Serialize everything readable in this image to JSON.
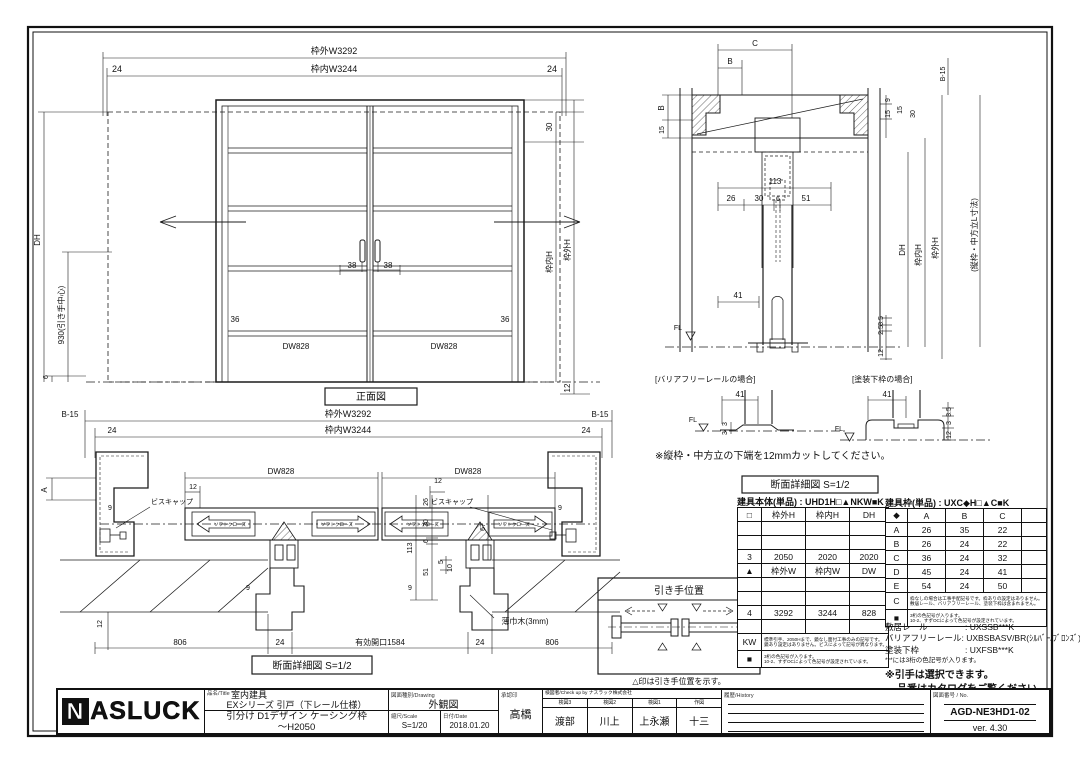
{
  "front": {
    "caption": "正面図",
    "w_out": "枠外W3292",
    "w_in": "枠内W3244",
    "m24l": "24",
    "m24r": "24",
    "h30": "30",
    "h_in": "枠内H",
    "h_out": "枠外H",
    "d12": "12",
    "dh": "DH",
    "center": "930(引き手中心)",
    "d6": "6",
    "d38l": "38",
    "d38r": "38",
    "d36l": "36",
    "d36r": "36",
    "dwl": "DW828",
    "dwr": "DW828"
  },
  "vsec": {
    "c": "C",
    "b_top": "B",
    "b_left": "B",
    "d15l": "15",
    "d9": "9",
    "d15a": "15",
    "d15b": "15",
    "d30": "30",
    "d113": "113",
    "d26": "26",
    "d30b": "30",
    "d6": "6",
    "d51": "51",
    "d41": "41",
    "d35": "3.5",
    "d25": "2.5",
    "d12": "12",
    "dh": "DH",
    "h_in": "枠内H",
    "h_out": "枠外H",
    "lnote": "(縦枠・中方立L寸法)",
    "b15": "B-15",
    "fl": "FL"
  },
  "details": {
    "left_title": "[バリアフリーレールの場合]",
    "right_title": "[塗装下枠の場合]",
    "l41": "41",
    "l3a": "3",
    "l3b": "3",
    "lfl": "FL",
    "r41": "41",
    "r35": "3.5",
    "r3": "3",
    "r12": "12",
    "rfl": "FL",
    "note": "※縦枠・中方立の下端を12mmカットしてください。",
    "caption": "断面詳細図 S=1/2"
  },
  "plan": {
    "b15l": "B-15",
    "b15r": "B-15",
    "w_out": "枠外W3292",
    "w_in": "枠内W3244",
    "m24l": "24",
    "m24r": "24",
    "dwl": "DW828",
    "dwr": "DW828",
    "d12l": "12",
    "d12r": "12",
    "d26": "26",
    "d30": "30",
    "d113": "113",
    "d6": "6",
    "d51": "51",
    "a": "A",
    "d67": "67",
    "d9a": "9",
    "d9b": "9",
    "d9c": "9",
    "d9d": "9",
    "d5": "5",
    "d10": "10",
    "d12b": "12",
    "biscap_l": "ビスキャップ",
    "biscap_r": "ビスキャップ",
    "soft1": "ソフトクローズ",
    "soft2": "ソフトクローズ",
    "soft3": "ソフトクローズ",
    "soft4": "ソフトクローズ",
    "skirting": "薄巾木(3mm)",
    "d806l": "806",
    "d24l": "24",
    "opening": "有効開口1584",
    "d24r": "24",
    "d806r": "806",
    "caption": "断面詳細図 S=1/2"
  },
  "handle": {
    "title": "引き手位置",
    "caption": "△印は引き手位置を示す。"
  },
  "table1": {
    "title": "建具本体(単品) : UHD1H□▲NKW■K",
    "h": [
      "□",
      "枠外H",
      "枠内H",
      "DH"
    ],
    "r3": [
      "3",
      "2050",
      "2020",
      "2020"
    ],
    "h2": [
      "▲",
      "枠外W",
      "枠内W",
      "DW"
    ],
    "r4": [
      "4",
      "3292",
      "3244",
      "828"
    ],
    "kw": "KW",
    "kw_note1": "標準引手、2050Hまで、鏡なし面付工事のみの記号です。",
    "kw_note2": "鏡あり設定はありません。ビスによって記号が異なります。",
    "sq": "■",
    "sq_note1": "3桁の色記号が入ります。",
    "sq_note2": "10-2、すずOCによって色記号が設定されています。"
  },
  "table2": {
    "title": "建具枠(単品) : UXC◆H□▲C■K",
    "h": [
      "◆",
      "A",
      "B",
      "C",
      ""
    ],
    "rows": [
      [
        "A",
        "26",
        "35",
        "22"
      ],
      [
        "B",
        "26",
        "24",
        "22"
      ],
      [
        "C",
        "36",
        "24",
        "32"
      ],
      [
        "D",
        "45",
        "24",
        "41"
      ],
      [
        "E",
        "54",
        "24",
        "50"
      ]
    ],
    "c": "C",
    "c_note1": "枠なしの場合は工事手配記号です。枠ありの設定はありません。",
    "c_note2": "敷居レール、バリアフリーレール、塗装下枠は含まれません。",
    "sq": "■",
    "sq_note1": "3桁の色記号が入ります。",
    "sq_note2": "10-2、すずOCによって色記号が設定されています。"
  },
  "products": {
    "rail_label": "敷居レール",
    "rail_value": ": UXSSB***K",
    "bf_label": "バリアフリーレール",
    "bf_value": ": UXBSBASV/BR(ｼﾙﾊﾞｰ/ﾌﾞﾛﾝｽﾞ)",
    "paint_label": "塗装下枠",
    "paint_value": ": UXFSB***K",
    "note1": "***には3桁の色記号が入ります。",
    "note2": "※引手は選択できます。",
    "note3": "品番はカタログをご覧ください。"
  },
  "titleblock": {
    "logo_n": "N",
    "logo": "ASLUCK",
    "name_label": "品名/Title",
    "name1": "室内建具",
    "name2": "EXシリーズ 引戸（下レール仕様）",
    "name3": "引分け D1デザイン ケーシング枠",
    "name4": "～H2050",
    "drawing_label": "図面種別/Drawing",
    "drawing_value": "外観図",
    "scale_label": "縮尺/Scale",
    "scale_value": "S=1/20",
    "date_label": "日付/Date",
    "date_value": "2018.01.20",
    "approve_label": "承認印",
    "approve_value": "高橋",
    "check_header": "検図者/Check up by ナスラック株式会社",
    "check_cols": [
      {
        "label": "検図3",
        "value": "渡部"
      },
      {
        "label": "検図2",
        "value": "川上"
      },
      {
        "label": "検図1",
        "value": "上永瀬"
      },
      {
        "label": "作図",
        "value": "十三"
      }
    ],
    "history_label": "履歴/History",
    "no_label": "図面番号 / No.",
    "no_value": "AGD-NE3HD1-02",
    "version": "ver. 4.30"
  }
}
